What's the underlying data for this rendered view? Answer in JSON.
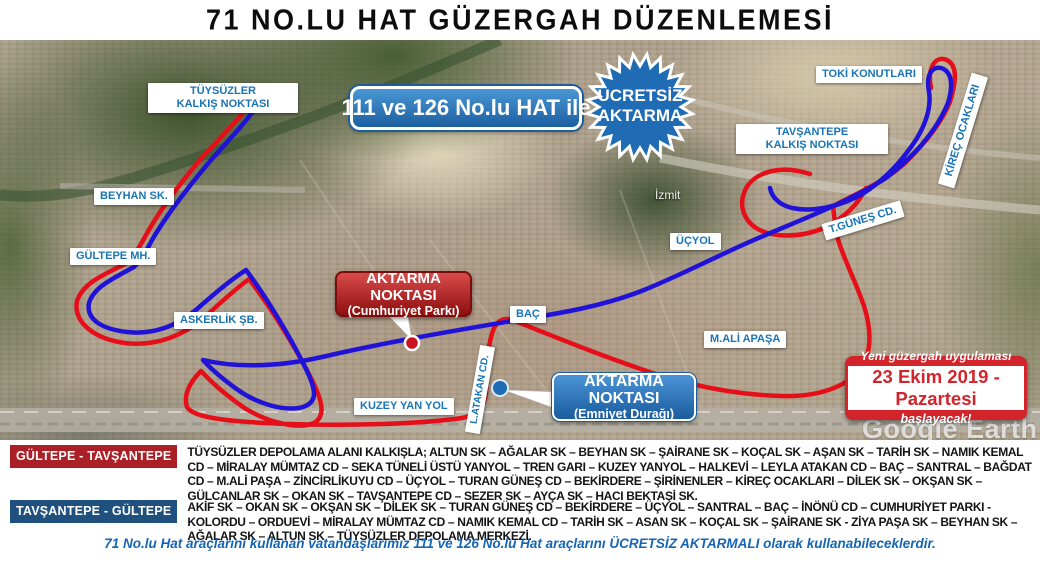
{
  "title": "71 NO.LU HAT GÜZERGAH DÜZENLEMESİ",
  "map": {
    "transfer_banner": "111 ve 126 No.lu HAT ile",
    "starburst": {
      "line1": "ÜCRETSİZ",
      "line2": "AKTARMA",
      "text": "ÜCRETSİZ\nAKTARMA"
    },
    "labels": {
      "tuysuzler": "TÜYSÜZLER\nKALKIŞ NOKTASI",
      "beyhan": "BEYHAN SK.",
      "gultepe": "GÜLTEPE MH.",
      "askerlik": "ASKERLİK ŞB.",
      "bac": "BAÇ",
      "kuzey_yan_yol": "KUZEY YAN YOL",
      "ucyol": "ÜÇYOL",
      "mali_apasa": "M.ALİ APAŞA",
      "tavsantepe": "TAVŞANTEPE\nKALKIŞ NOKTASI",
      "toki": "TOKİ KONUTLARI",
      "gunes_cd": "T.GÜNEŞ CD.",
      "kirec_ocaklari": "KİREÇ OCAKLARI",
      "latakan_cd": "L.ATAKAN CD.",
      "izmit": "İzmit"
    },
    "callout_cumhuriyet": {
      "title": "AKTARMA NOKTASI",
      "subtitle": "(Cumhuriyet Parkı)"
    },
    "callout_emniyet": {
      "title": "AKTARMA NOKTASI",
      "subtitle": "(Emniyet Durağı)"
    },
    "announcement": {
      "line1": "Yeni güzergah uygulaması",
      "line2": "23 Ekim 2019 - Pazartesi",
      "line3": "başlayacak!"
    },
    "watermark": "Google Earth",
    "colors": {
      "route_red": "#e60e19",
      "route_blue": "#2012d6",
      "label_text_blue": "#1a74b4",
      "banner_blue": "#1c5fa0",
      "announce_red": "#d3242b",
      "badge_red": "#ab2026",
      "badge_blue": "#20517e",
      "footer_blue": "#1565b4"
    }
  },
  "routes": [
    {
      "badge": "GÜLTEPE - TAVŞANTEPE",
      "description": "TÜYSÜZLER DEPOLAMA ALANI KALKIŞLA; ALTUN SK – AĞALAR SK – BEYHAN SK – ŞAİRANE SK – KOÇAL SK – AŞAN SK – TARİH SK – NAMIK KEMAL CD – MİRALAY MÜMTAZ CD – SEKA TÜNELİ ÜSTÜ YANYOL – TREN GARI – KUZEY YANYOL – HALKEVİ – LEYLA ATAKAN CD – BAÇ – SANTRAL – BAĞDAT CD – M.ALİ PAŞA – ZİNCİRLİKUYU CD – ÜÇYOL – TURAN GÜNEŞ CD – BEKİRDERE – ŞİRİNENLER – KİREÇ OCAKLARI – DİLEK SK – OKŞAN SK – GÜLCANLAR SK – OKAN SK – TAVŞANTEPE CD – SEZER SK – AYÇA SK – HACI BEKTAŞİ SK."
    },
    {
      "badge": "TAVŞANTEPE - GÜLTEPE",
      "description": "AKİF SK – OKAN SK – OKŞAN SK – DİLEK SK – TURAN GÜNEŞ CD – BEKİRDERE – ÜÇYOL – SANTRAL – BAÇ – İNÖNÜ CD – CUMHURİYET PARKI - KOLORDU – ORDUEVİ – MİRALAY MÜMTAZ CD – NAMIK KEMAL CD – TARİH SK – ASAN SK – KOÇAL SK – ŞAİRANE SK - ZİYA PAŞA SK – BEYHAN SK – AĞALAR SK – ALTUN SK – TÜYSÜZLER DEPOLAMA MERKEZİ."
    }
  ],
  "footer": "71 No.lu Hat araçlarını kullanan vatandaşlarımız 111 ve 126 No.lu Hat araçlarını ÜCRETSİZ AKTARMALI olarak kullanabileceklerdir."
}
